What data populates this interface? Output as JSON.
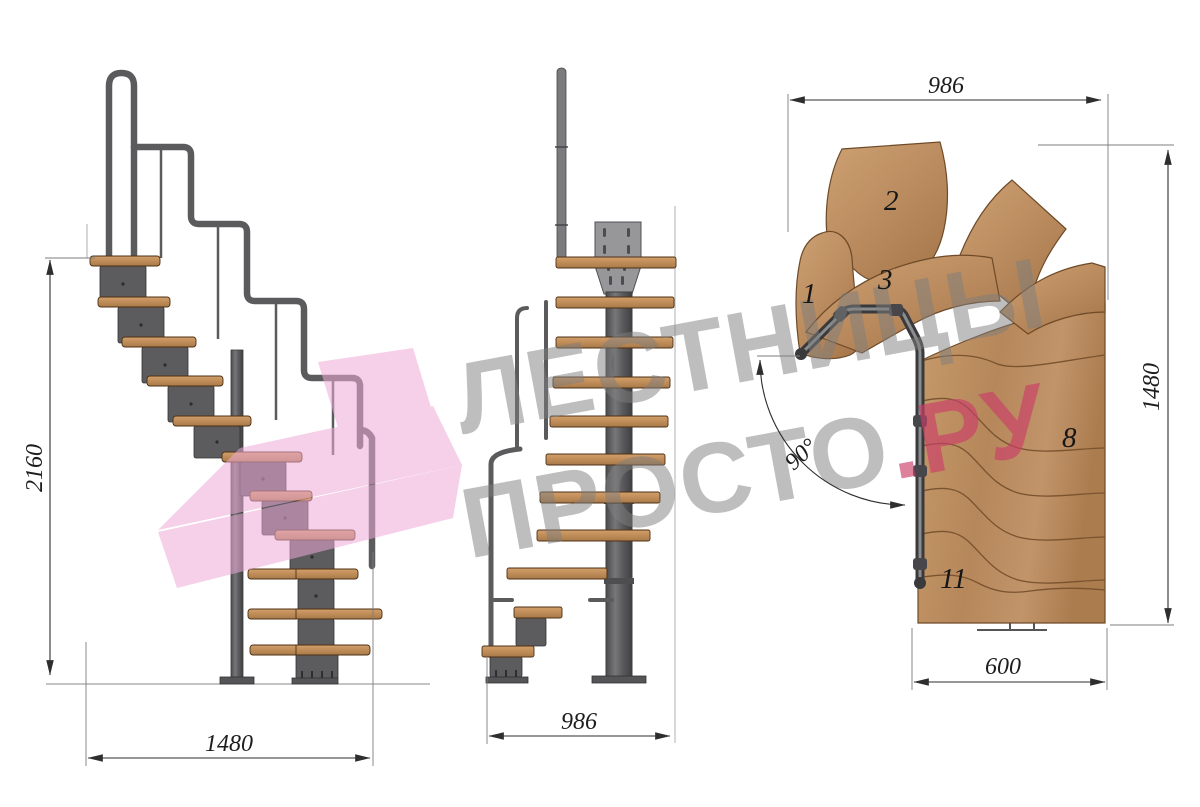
{
  "drawing": {
    "kind": "modular staircase technical drawing, three views (side, front, plan)"
  },
  "dimensions": {
    "side_height": "2160",
    "side_length": "1480",
    "front_width": "986",
    "plan_top_width": "986",
    "plan_right_height": "1480",
    "plan_bottom_width": "600",
    "turn_angle": "90°"
  },
  "plan_step_labels": {
    "s1": "1",
    "s2": "2",
    "s3": "3",
    "s8": "8",
    "s11": "11"
  },
  "watermark": {
    "line1": "ЛЕСТНИЦЫ",
    "line2_gray": "ПРОСТО",
    "line2_pink": ".РУ"
  },
  "colors": {
    "wood": "#bd8c5c",
    "wood_dark_edge": "#6e4a28",
    "metal": "#5f5f62",
    "metal_dark": "#3a3a3d",
    "plate_gray": "#97979a",
    "dim_line": "#3b3b3b",
    "watermark_gray": "#7f7f7f",
    "watermark_pink": "#cb3d69",
    "shape_pink": "#f0b5da"
  }
}
